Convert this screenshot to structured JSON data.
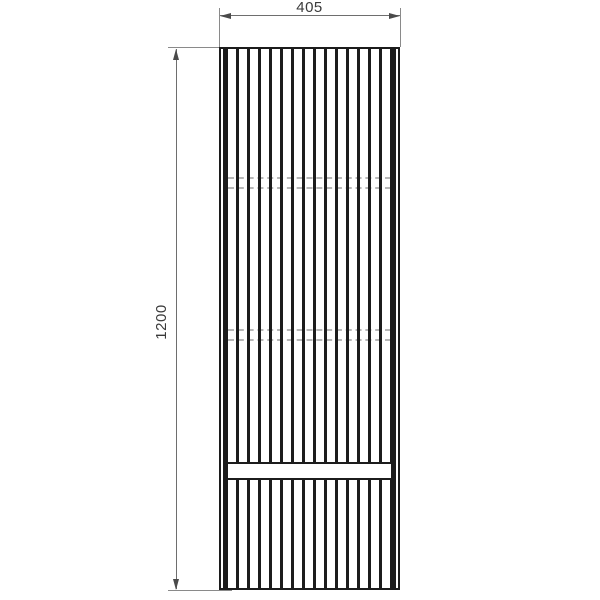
{
  "drawing": {
    "type": "technical-drawing",
    "description": "Front elevation of a tall fluted / slatted cabinet panel with two hidden (dashed) shelf lines and one solid horizontal rail near the bottom",
    "width_dim": {
      "label": "405"
    },
    "height_dim": {
      "label": "1200"
    },
    "panel": {
      "hidden_shelf_line_pairs": 2,
      "solid_rails": 1
    },
    "colors": {
      "outline": "#1c1c1c",
      "dimension_line": "#6e6e6e",
      "hidden_line": "#b8b8b8",
      "text": "#3a3a3a",
      "background": "#ffffff"
    }
  }
}
